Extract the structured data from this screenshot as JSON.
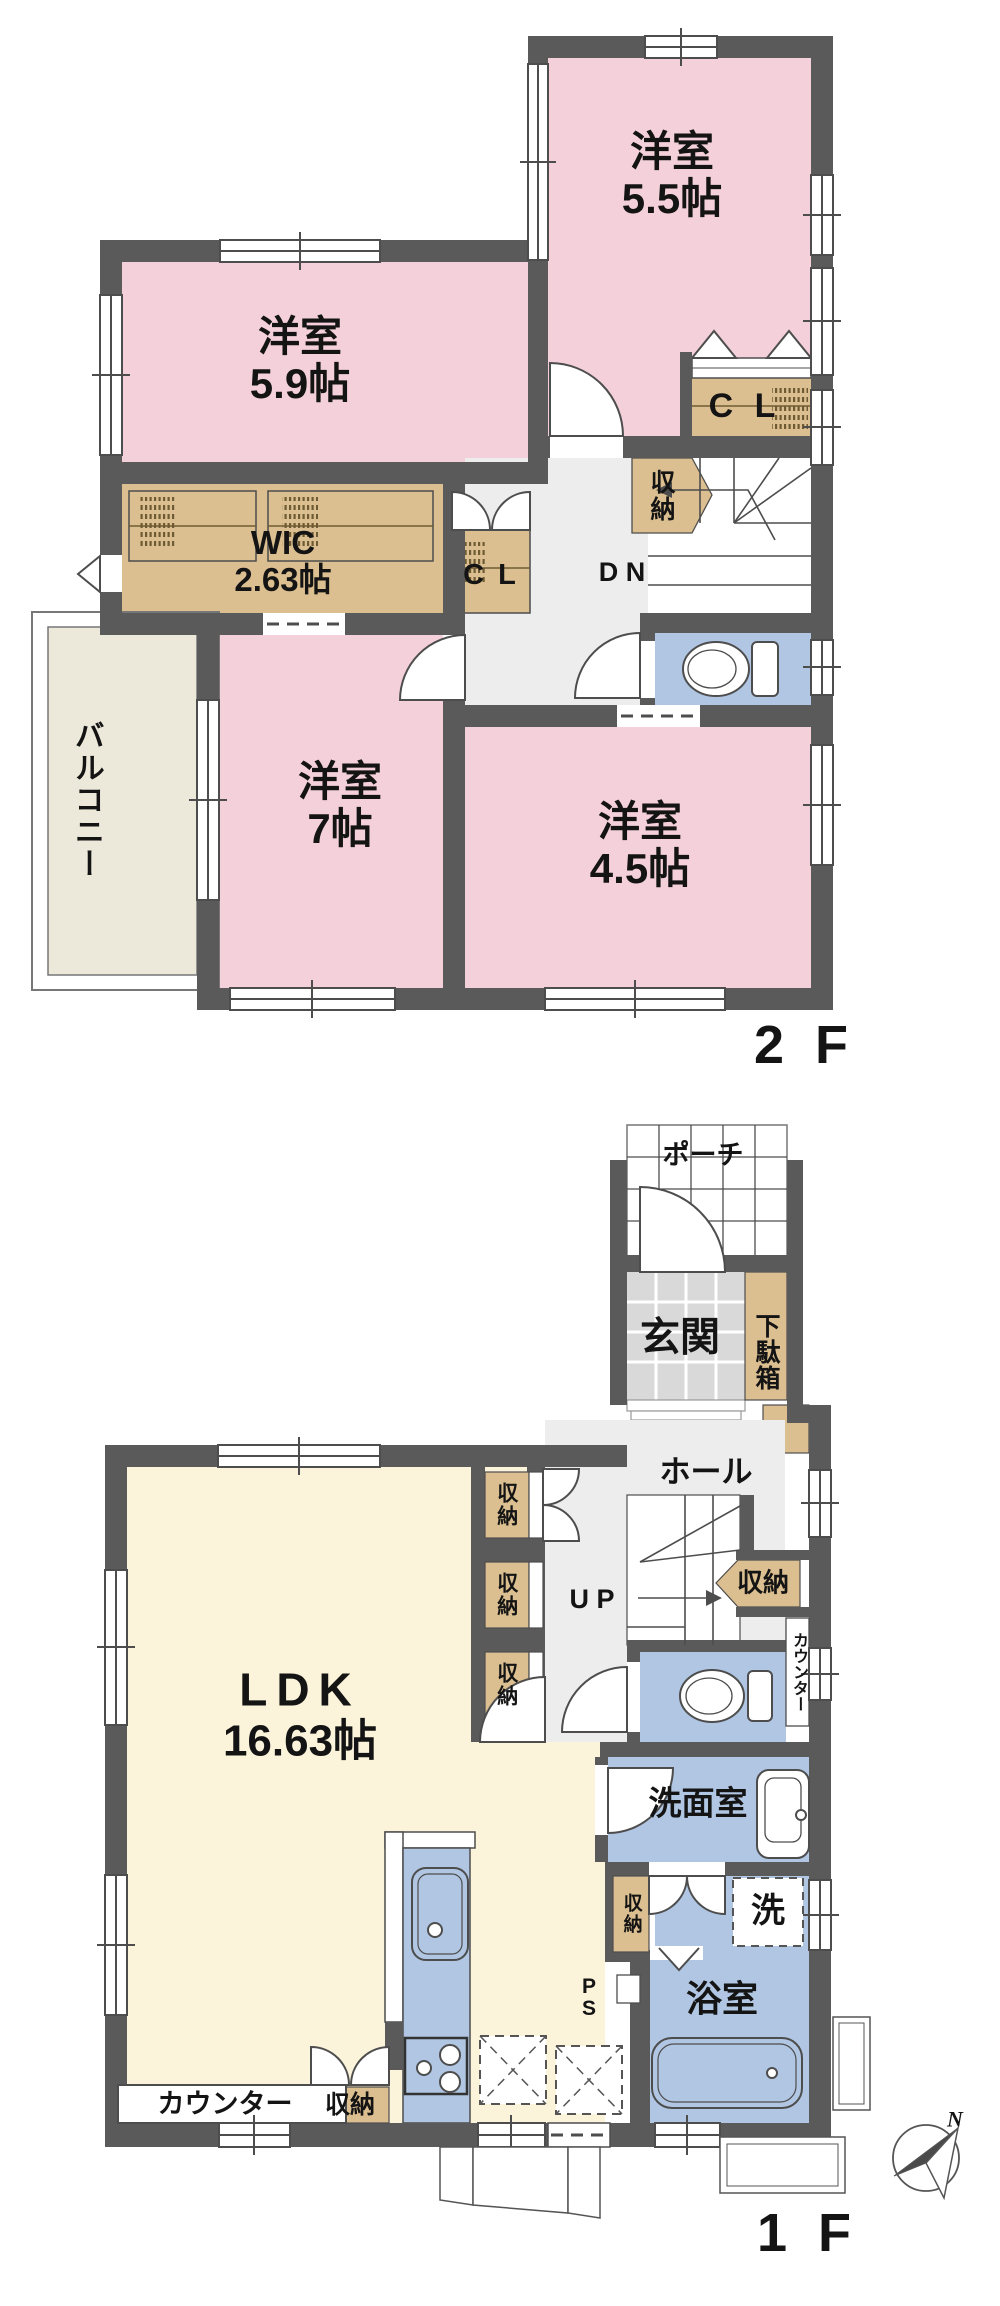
{
  "palette": {
    "wall": "#5a5a5a",
    "room_pink": "#f4d0da",
    "closet_tan": "#dcbf90",
    "ldk_cream": "#fbf3da",
    "balcony": "#ece8da",
    "water_blue": "#b0c6e2",
    "hall_gray": "#ededed",
    "tile_gray": "#d9d9d9"
  },
  "floor2": {
    "floor_label": "2 F",
    "yoshitsu55": {
      "name": "洋室",
      "size": "5.5帖"
    },
    "yoshitsu59": {
      "name": "洋室",
      "size": "5.9帖"
    },
    "yoshitsu7": {
      "name": "洋室",
      "size": "7帖"
    },
    "yoshitsu45": {
      "name": "洋室",
      "size": "4.5帖"
    },
    "wic": {
      "name": "WIC",
      "size": "2.63帖"
    },
    "cl_top": "C L",
    "cl_mid": "C L",
    "shunou_stairs": "収納",
    "dn": "D N",
    "balcony": "バルコニー"
  },
  "floor1": {
    "floor_label": "1 F",
    "porch": "ポーチ",
    "genkan": "玄関",
    "getabako": "下駄箱",
    "hall": "ホール",
    "up": "U P",
    "shunou_a": "収納",
    "shunou_b": "収納",
    "shunou_c": "収納",
    "shunou_hall": "収納",
    "counter_wc": "カウンター",
    "ldk": {
      "name": "LDK",
      "size": "16.63帖"
    },
    "senmen": "洗面室",
    "laundry": "洗",
    "shunou_laundry": "収納",
    "ps": "P S",
    "bath": "浴室",
    "counter_ldk": "カウンター",
    "shunou_ldk_south": "収納"
  },
  "compass": {
    "north_label": "N"
  }
}
